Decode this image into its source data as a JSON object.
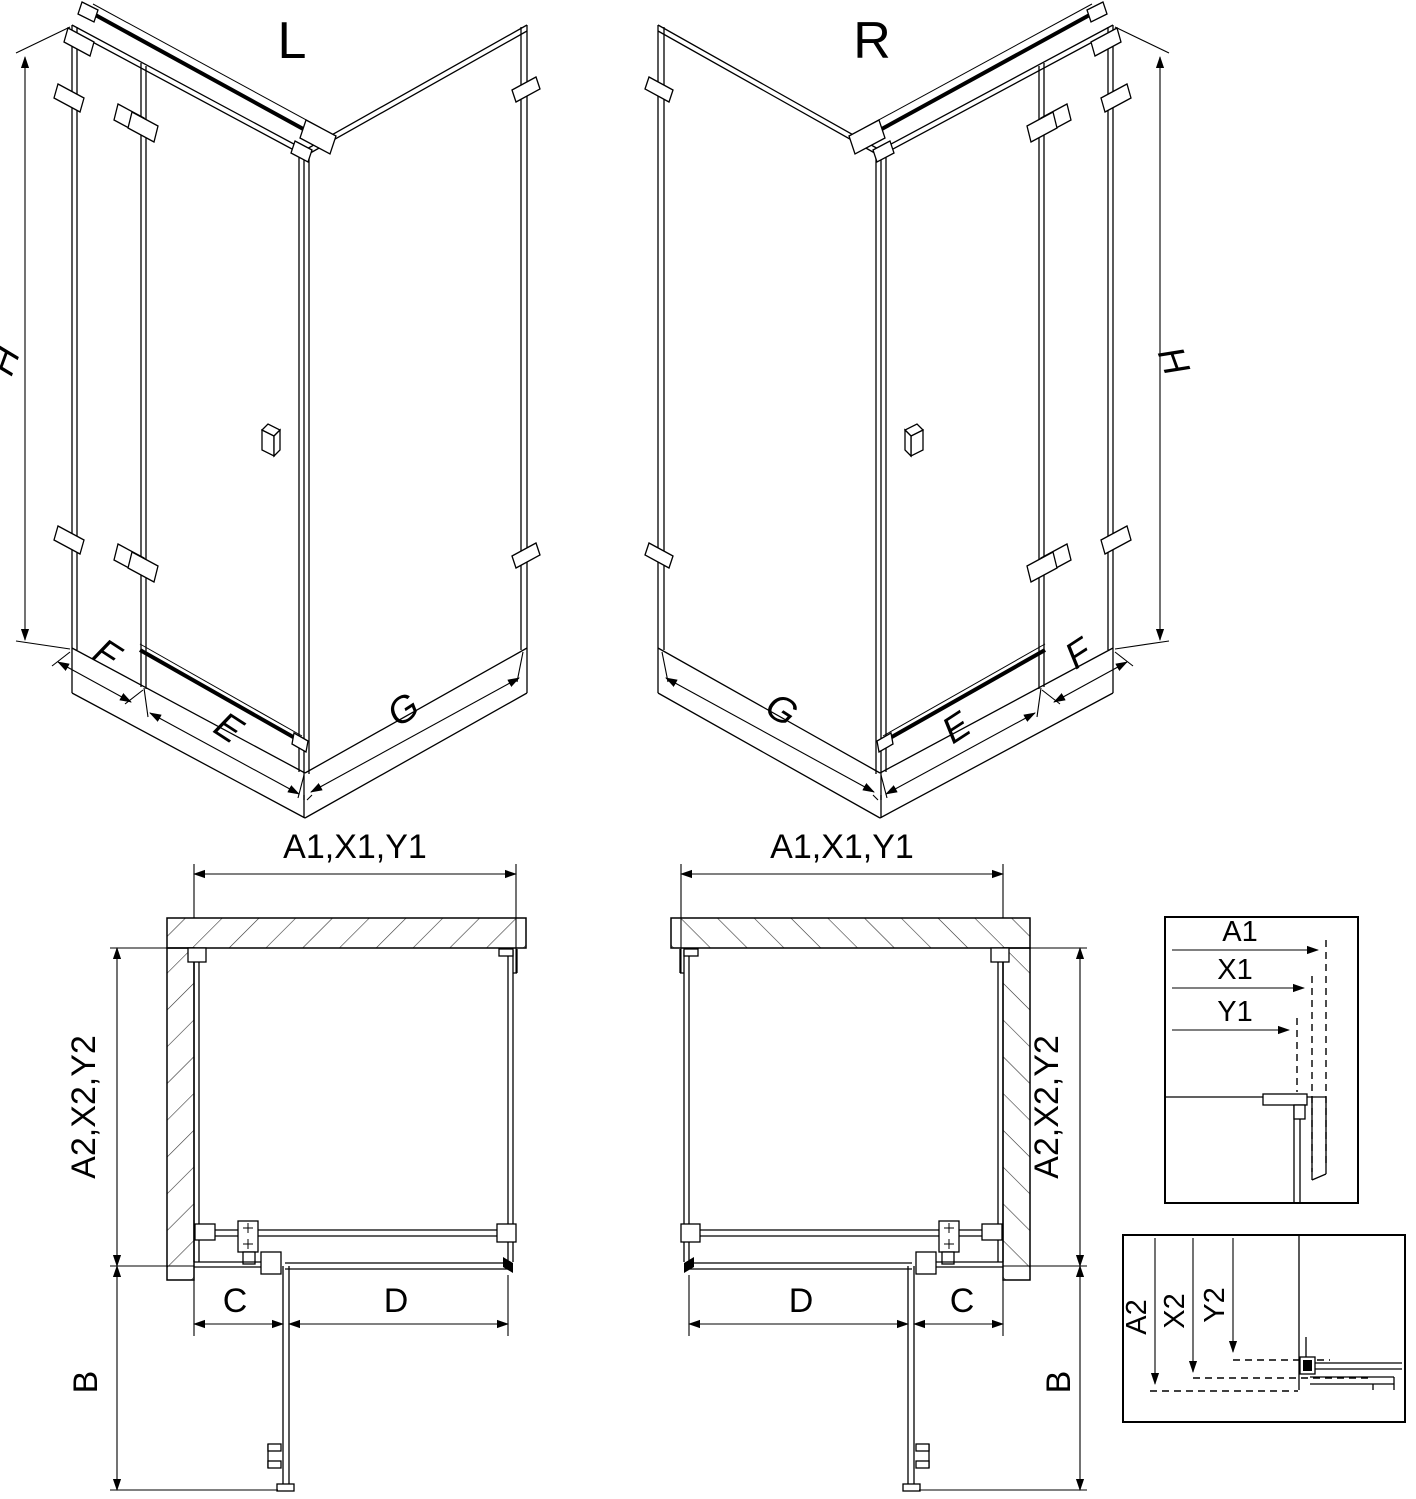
{
  "views": {
    "iso_left": {
      "title": "L",
      "height": "H",
      "panel_f": "F",
      "door_e": "E",
      "panel_g": "G"
    },
    "iso_right": {
      "title": "R",
      "height": "H",
      "panel_f": "F",
      "door_e": "E",
      "panel_g": "G"
    },
    "plan_left": {
      "top_width": "A1,X1,Y1",
      "side_depth": "A2,X2,Y2",
      "door_projection": "B",
      "fixed_segment": "C",
      "door_width": "D"
    },
    "plan_right": {
      "top_width": "A1,X1,Y1",
      "side_depth": "A2,X2,Y2",
      "door_projection": "B",
      "fixed_segment": "C",
      "door_width": "D"
    },
    "detail_top": {
      "rows": [
        "A1",
        "X1",
        "Y1"
      ]
    },
    "detail_bottom": {
      "rows": [
        "A2",
        "X2",
        "Y2"
      ]
    }
  },
  "colors": {
    "line": "#000000",
    "background": "#ffffff"
  }
}
